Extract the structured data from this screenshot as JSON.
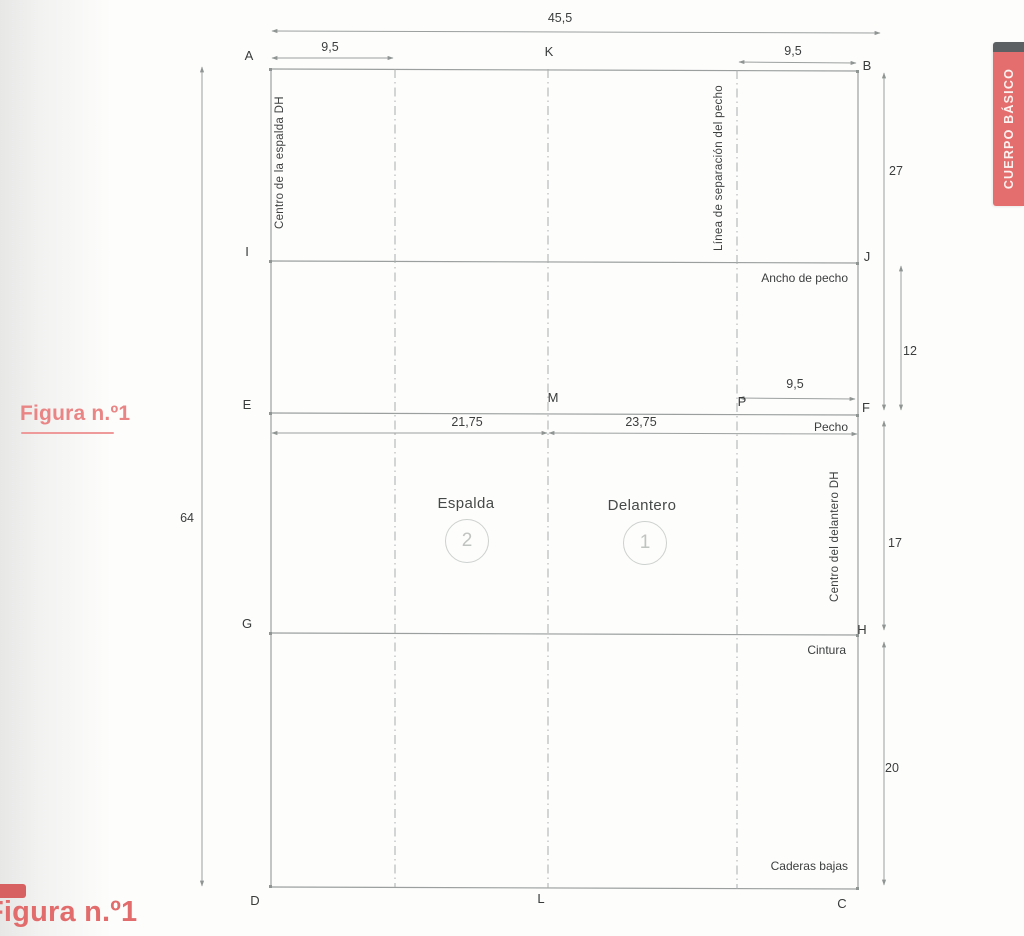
{
  "side_tab": {
    "label": "CUERPO BÁSICO",
    "bg_color": "#e46e6e",
    "cap_color": "#5c6062",
    "text_color": "#fbf2f0"
  },
  "figure_caption": {
    "label": "Figura n.º1",
    "color": "#e98585"
  },
  "footer_caption": {
    "label": "Figura n.º1",
    "color": "#e26c6c"
  },
  "diagram": {
    "points": {
      "A": "A",
      "B": "B",
      "C": "C",
      "D": "D",
      "E": "E",
      "F": "F",
      "G": "G",
      "H": "H",
      "I": "I",
      "J": "J",
      "K": "K",
      "L": "L",
      "M": "M",
      "P": "P"
    },
    "dimensions": {
      "total_width": "45,5",
      "back_top_segment": "9,5",
      "front_top_segment": "9,5",
      "total_height": "64",
      "b_to_f": "27",
      "j_to_f": "12",
      "f_to_h": "17",
      "h_to_c": "20",
      "p_to_f": "9,5",
      "back_half_width": "21,75",
      "front_half_width": "23,75"
    },
    "guide_labels": {
      "center_back": "Centro de la espalda DH",
      "bust_separation": "Línea de separación del pecho",
      "center_front": "Centro del delantero DH",
      "chest_width_line": "Ancho de pecho",
      "bust_line": "Pecho",
      "waist_line": "Cintura",
      "low_hip_line": "Caderas bajas"
    },
    "pieces": {
      "back": {
        "label": "Espalda",
        "number": "2"
      },
      "front": {
        "label": "Delantero",
        "number": "1"
      }
    },
    "line_color": "#9ba09e",
    "text_color": "#3b3e3d"
  }
}
